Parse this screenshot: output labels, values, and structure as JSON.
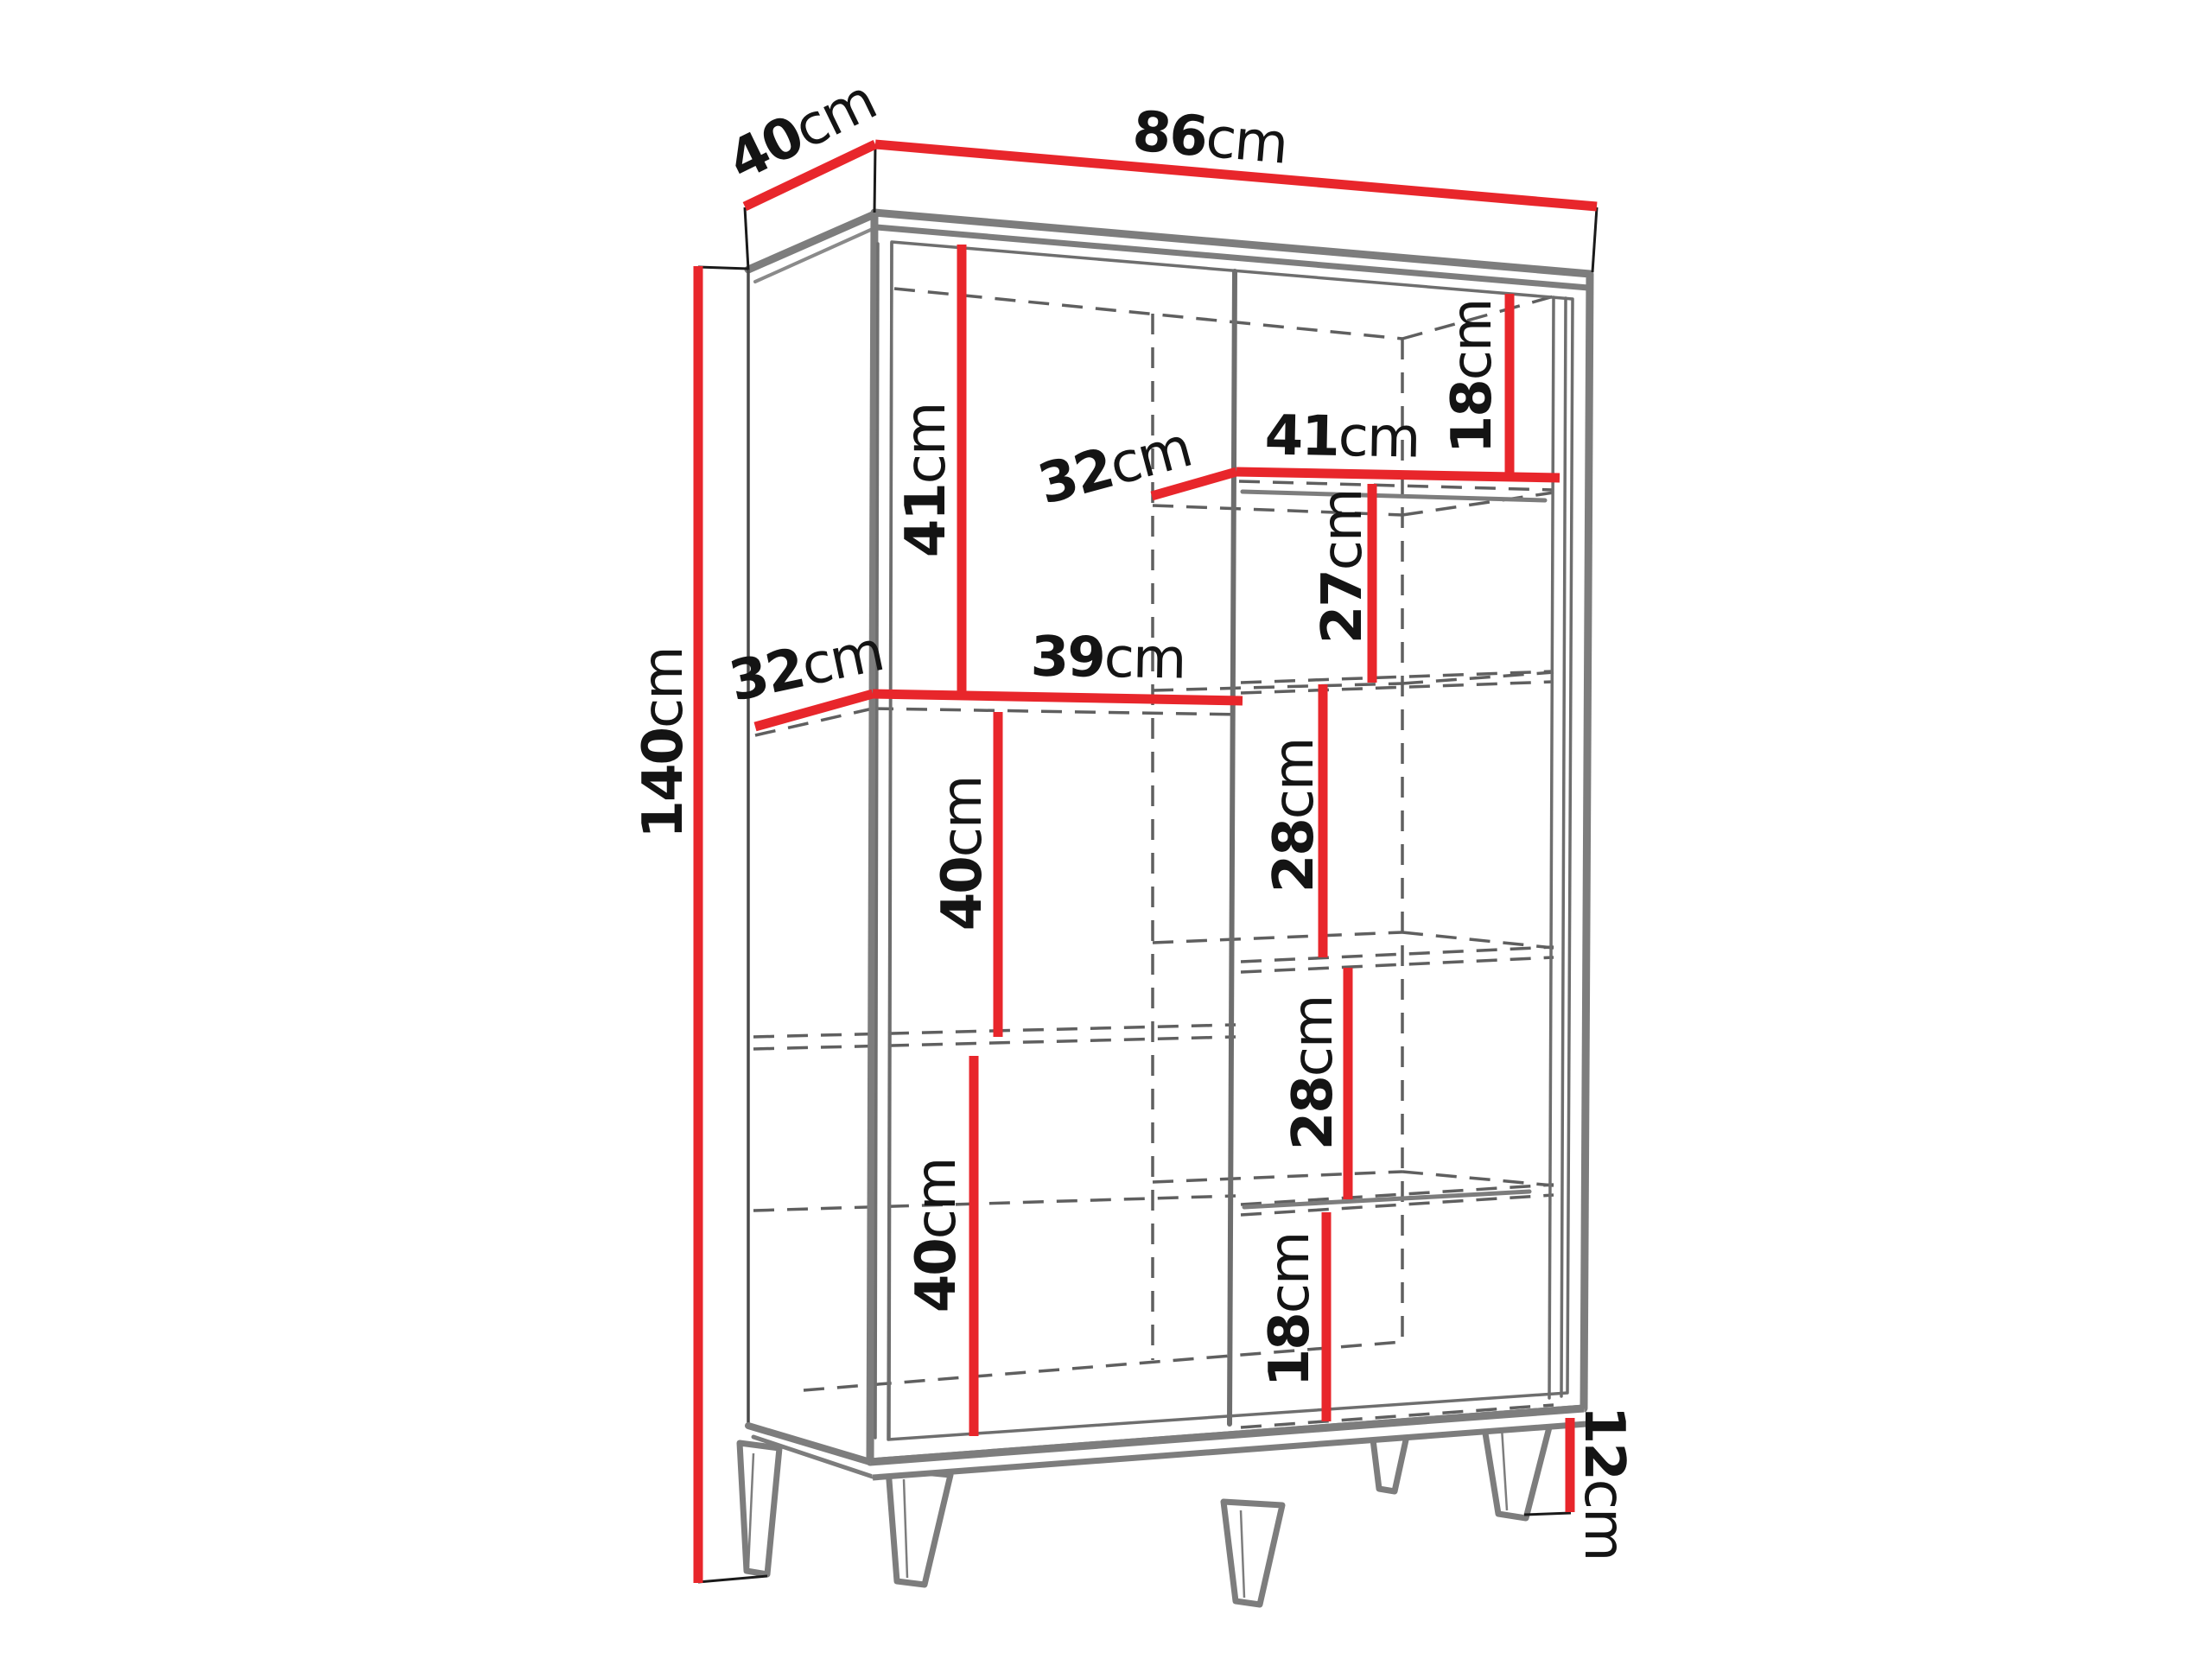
{
  "diagram": {
    "type": "furniture-dimension-diagram",
    "subject": "three-section cabinet / wardrobe wireframe with shelves and splayed legs",
    "unit": "cm",
    "colors": {
      "dimension_line": "#e8262b",
      "outline": "#7d7d7d",
      "hidden_edge": "#5f5f5f",
      "tick": "#1a1a1a",
      "label_text": "#141414",
      "background": "#ffffff"
    }
  },
  "labels": {
    "top_depth": {
      "value": "40",
      "unit": "cm"
    },
    "top_width": {
      "value": "86",
      "unit": "cm"
    },
    "height": {
      "value": "140",
      "unit": "cm"
    },
    "right_top_gap": {
      "value": "18",
      "unit": "cm"
    },
    "top_shelf_depth": {
      "value": "32",
      "unit": "cm"
    },
    "top_shelf_width": {
      "value": "41",
      "unit": "cm"
    },
    "left_top_gap": {
      "value": "41",
      "unit": "cm"
    },
    "right_gap_27": {
      "value": "27",
      "unit": "cm"
    },
    "mid_shelf_depth": {
      "value": "32",
      "unit": "cm"
    },
    "mid_shelf_width": {
      "value": "39",
      "unit": "cm"
    },
    "left_mid_gap": {
      "value": "40",
      "unit": "cm"
    },
    "left_bottom_gap": {
      "value": "40",
      "unit": "cm"
    },
    "right_gap_28_upper": {
      "value": "28",
      "unit": "cm"
    },
    "right_gap_28_lower": {
      "value": "28",
      "unit": "cm"
    },
    "right_bottom_gap": {
      "value": "18",
      "unit": "cm"
    },
    "leg_height": {
      "value": "12",
      "unit": "cm"
    }
  }
}
